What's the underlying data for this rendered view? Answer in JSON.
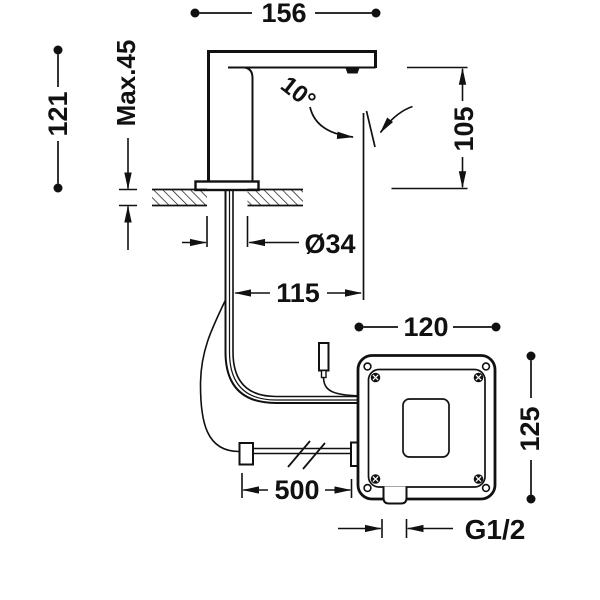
{
  "title": "Deck-mounted electronic sensor basin tap with control box - dimensional drawing",
  "colors": {
    "ink": "#111111",
    "background": "#ffffff"
  },
  "dimensions": {
    "spout_reach": "156",
    "total_height": "121",
    "max_deck_thickness": "Max.45",
    "spout_height": "105",
    "stream_angle": "10°",
    "hole_diameter": "Ø34",
    "stream_offset": "115",
    "box_width": "120",
    "box_height": "125",
    "hose_length": "500",
    "connection_thread": "G1/2"
  }
}
